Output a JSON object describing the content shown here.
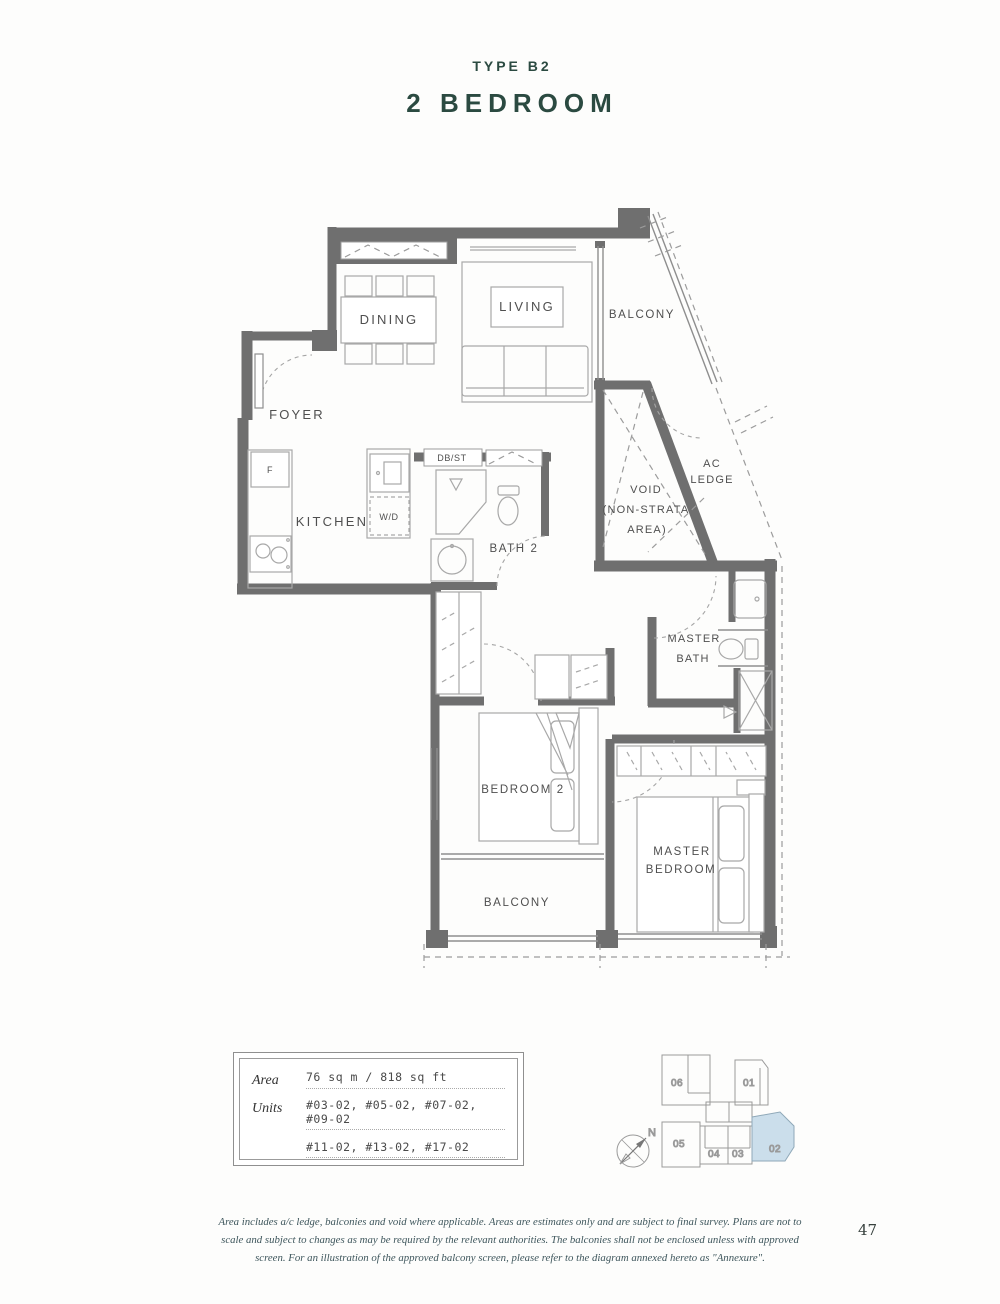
{
  "header": {
    "type_label": "TYPE B2",
    "title": "2 BEDROOM"
  },
  "floor_plan": {
    "labels": {
      "dining": "DINING",
      "living": "LIVING",
      "balcony_top": "BALCONY",
      "foyer": "FOYER",
      "kitchen": "KITCHEN",
      "fridge": "F",
      "washer_dryer": "W/D",
      "db_st": "DB/ST",
      "bath2": "BATH 2",
      "void": {
        "line1": "VOID",
        "line2": "(NON-STRATA",
        "line3": "AREA)"
      },
      "ac_ledge": {
        "line1": "AC",
        "line2": "LEDGE"
      },
      "master_bath": {
        "line1": "MASTER",
        "line2": "BATH"
      },
      "bedroom2": "BEDROOM 2",
      "master_bedroom": {
        "line1": "MASTER",
        "line2": "BEDROOM"
      },
      "balcony_bottom": "BALCONY"
    }
  },
  "info_box": {
    "area_label": "Area",
    "area_value": "76 sq m / 818 sq ft",
    "units_label": "Units",
    "units_line1": "#03-02, #05-02, #07-02, #09-02",
    "units_line2": "#11-02, #13-02, #17-02"
  },
  "key_plan": {
    "compass_label": "N",
    "units": [
      "06",
      "01",
      "05",
      "04",
      "03",
      "02"
    ],
    "highlighted_unit": "02",
    "highlight_color": "#cbdeeb"
  },
  "footer": {
    "disclaimer": "Area includes a/c ledge, balconies and void where applicable. Areas are estimates only and are subject to final survey. Plans are not to scale and subject to changes as may be required by the relevant authorities. The balconies shall not be enclosed unless with approved screen. For an illustration of the approved balcony screen, please refer to the diagram annexed hereto as \"Annexure\".",
    "page_number": "47"
  },
  "colors": {
    "accent_green": "#2b4a41",
    "wall_gray": "#6f6f6f",
    "line_gray": "#9c9c9c",
    "text_gray": "#4f4f4f",
    "highlight_blue": "#cbdeeb"
  }
}
